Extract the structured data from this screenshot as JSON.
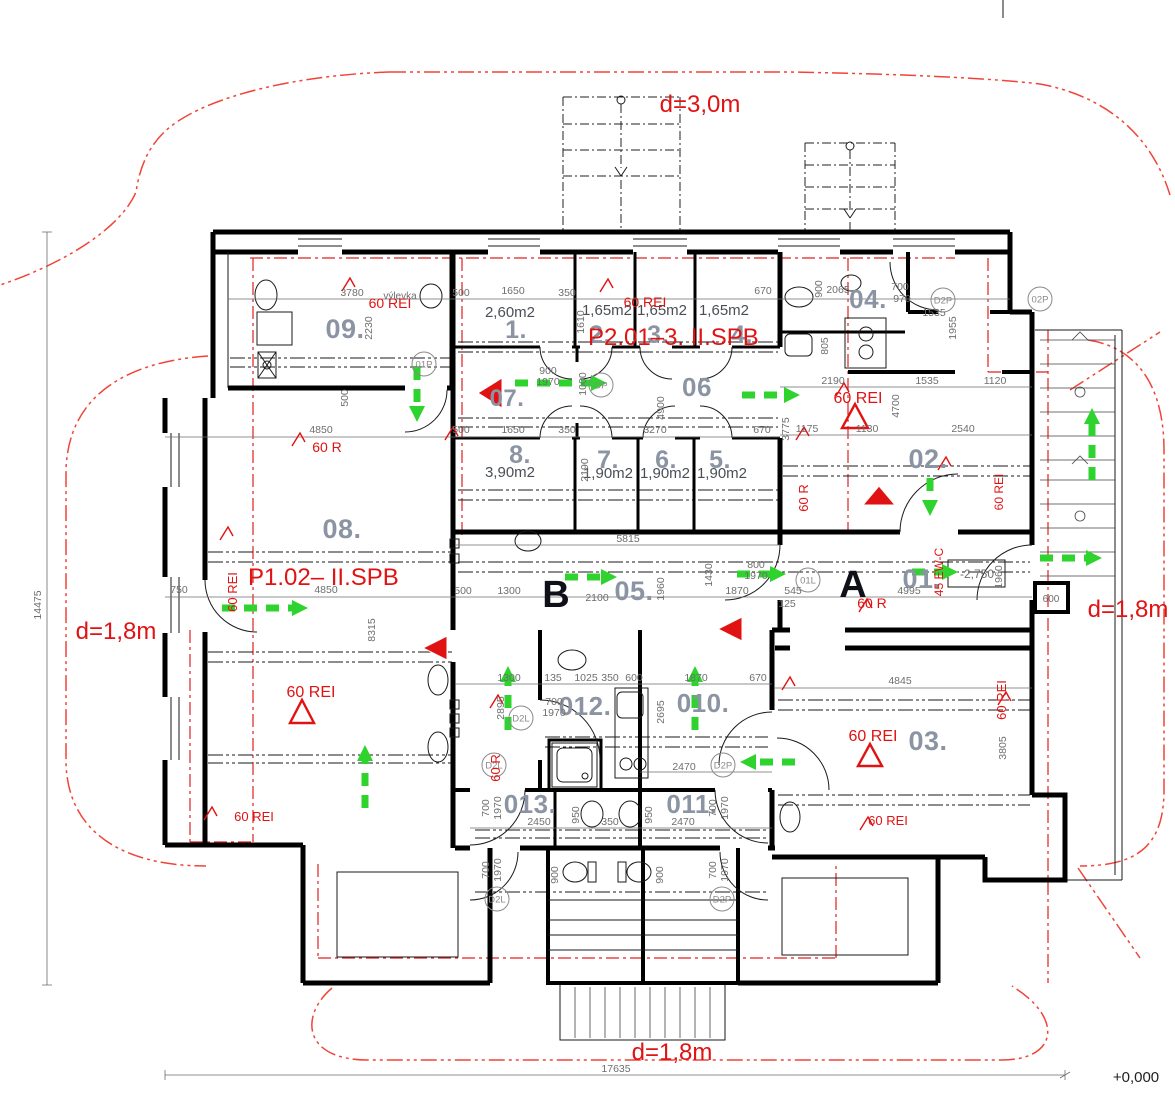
{
  "drawing": {
    "type": "architectural-floor-plan",
    "elevation_datum": "+0,000",
    "colors": {
      "walls": "#000000",
      "room_numbers": "#8b94a3",
      "fire_annotations": "#e11212",
      "escape_arrows": "#2ed32e",
      "dimensions": "#6e6e6e"
    }
  },
  "room_labels": [
    {
      "t": "09.",
      "x": 345,
      "y": 338,
      "s": 27
    },
    {
      "t": "1.",
      "x": 516,
      "y": 338,
      "s": 25
    },
    {
      "t": "2.",
      "x": 600,
      "y": 343,
      "s": 25
    },
    {
      "t": "3.",
      "x": 658,
      "y": 343,
      "s": 25
    },
    {
      "t": "4.",
      "x": 742,
      "y": 343,
      "s": 25
    },
    {
      "t": "07.",
      "x": 507,
      "y": 406,
      "s": 24
    },
    {
      "t": "06",
      "x": 697,
      "y": 396,
      "s": 26
    },
    {
      "t": "8.",
      "x": 520,
      "y": 463,
      "s": 25
    },
    {
      "t": "7.",
      "x": 608,
      "y": 468,
      "s": 25
    },
    {
      "t": "6.",
      "x": 666,
      "y": 468,
      "s": 25
    },
    {
      "t": "5.",
      "x": 720,
      "y": 468,
      "s": 25
    },
    {
      "t": "04.",
      "x": 868,
      "y": 308,
      "s": 26
    },
    {
      "t": "02.",
      "x": 928,
      "y": 468,
      "s": 27
    },
    {
      "t": "08.",
      "x": 342,
      "y": 538,
      "s": 27
    },
    {
      "t": "05.",
      "x": 634,
      "y": 600,
      "s": 27
    },
    {
      "t": "01.",
      "x": 922,
      "y": 588,
      "s": 27
    },
    {
      "t": "012.",
      "x": 585,
      "y": 715,
      "s": 26
    },
    {
      "t": "010.",
      "x": 703,
      "y": 712,
      "s": 26
    },
    {
      "t": "013.",
      "x": 530,
      "y": 813,
      "s": 26
    },
    {
      "t": "011.",
      "x": 692,
      "y": 813,
      "s": 26
    },
    {
      "t": "03.",
      "x": 928,
      "y": 750,
      "s": 27
    }
  ],
  "area_labels": [
    {
      "t": "2,60m2",
      "x": 510,
      "y": 317
    },
    {
      "t": "1,65m2",
      "x": 607,
      "y": 315
    },
    {
      "t": "1,65m2",
      "x": 662,
      "y": 315
    },
    {
      "t": "1,65m2",
      "x": 724,
      "y": 315
    },
    {
      "t": "3,90m2",
      "x": 510,
      "y": 477
    },
    {
      "t": "1,90m2",
      "x": 608,
      "y": 478
    },
    {
      "t": "1,90m2",
      "x": 665,
      "y": 478
    },
    {
      "t": "1,90m2",
      "x": 722,
      "y": 478
    }
  ],
  "section_letters": [
    {
      "t": "B",
      "x": 556,
      "y": 607
    },
    {
      "t": "A",
      "x": 853,
      "y": 597
    }
  ],
  "red_labels": [
    {
      "t": "d=3,0m",
      "x": 700,
      "y": 112,
      "s": 24
    },
    {
      "t": "d=1,8m",
      "x": 116,
      "y": 639,
      "s": 24
    },
    {
      "t": "d=1,8m",
      "x": 1128,
      "y": 617,
      "s": 24
    },
    {
      "t": "d=1,8m",
      "x": 672,
      "y": 1060,
      "s": 24
    },
    {
      "t": "P2.01–3. II.SPB",
      "x": 588,
      "y": 345,
      "s": 24,
      "a": "start"
    },
    {
      "t": "P1.02–  II.SPB",
      "x": 248,
      "y": 585,
      "s": 24,
      "a": "start"
    },
    {
      "t": "60 REI",
      "x": 390,
      "y": 308,
      "s": 14
    },
    {
      "t": "60 REI",
      "x": 645,
      "y": 307,
      "s": 14
    },
    {
      "t": "60 REI",
      "x": 858,
      "y": 403,
      "s": 16
    },
    {
      "t": "60 REI",
      "x": 311,
      "y": 697,
      "s": 16
    },
    {
      "t": "60 REI",
      "x": 254,
      "y": 821,
      "s": 13
    },
    {
      "t": "60 REI",
      "x": 873,
      "y": 741,
      "s": 16
    },
    {
      "t": "60 REI",
      "x": 888,
      "y": 825,
      "s": 13
    },
    {
      "t": "60 REI",
      "x": 237,
      "y": 592,
      "s": 13,
      "r": 1
    },
    {
      "t": "60 REI",
      "x": 1006,
      "y": 700,
      "s": 13,
      "r": 1
    },
    {
      "t": "60 REI",
      "x": 1003,
      "y": 492,
      "s": 12,
      "r": 1
    },
    {
      "t": "60 R",
      "x": 327,
      "y": 452,
      "s": 14
    },
    {
      "t": "60 R",
      "x": 872,
      "y": 608,
      "s": 14
    },
    {
      "t": "60 R",
      "x": 808,
      "y": 498,
      "s": 13,
      "r": 1
    },
    {
      "t": "60 R",
      "x": 500,
      "y": 768,
      "s": 13,
      "r": 1
    },
    {
      "t": "45 EW-C",
      "x": 943,
      "y": 572,
      "s": 12,
      "r": 1
    }
  ],
  "dim_labels": [
    [
      "3780",
      352,
      296
    ],
    [
      "500",
      461,
      296
    ],
    [
      "1650",
      513,
      294
    ],
    [
      "350",
      567,
      296
    ],
    [
      "670",
      763,
      294
    ],
    [
      "2065",
      838,
      293
    ],
    [
      "900",
      822,
      289,
      1
    ],
    [
      "700",
      900,
      290
    ],
    [
      "970",
      902,
      302
    ],
    [
      "1535",
      934,
      316
    ],
    [
      "1955",
      956,
      328,
      1
    ],
    [
      "805",
      828,
      346,
      1
    ],
    [
      "500",
      461,
      433
    ],
    [
      "1650",
      513,
      433
    ],
    [
      "350",
      567,
      433
    ],
    [
      "3270",
      655,
      433
    ],
    [
      "670",
      762,
      433
    ],
    [
      "3775",
      789,
      429,
      1
    ],
    [
      "2190",
      833,
      384
    ],
    [
      "4700",
      899,
      406,
      1
    ],
    [
      "1535",
      927,
      384
    ],
    [
      "1120",
      995,
      384
    ],
    [
      "1175",
      807,
      432
    ],
    [
      "1130",
      867,
      432
    ],
    [
      "2540",
      963,
      432
    ],
    [
      "2230",
      372,
      328,
      1
    ],
    [
      "500",
      348,
      398,
      1
    ],
    [
      "4850",
      321,
      433
    ],
    [
      "1610",
      584,
      322,
      1
    ],
    [
      "750",
      179,
      593
    ],
    [
      "14475",
      41,
      605,
      1
    ],
    [
      "4850",
      326,
      593
    ],
    [
      "8315",
      375,
      630,
      1
    ],
    [
      "500",
      463,
      594
    ],
    [
      "1300",
      509,
      594
    ],
    [
      "2100",
      597,
      601
    ],
    [
      "5815",
      628,
      542
    ],
    [
      "1960",
      664,
      589,
      1
    ],
    [
      "1870",
      737,
      594
    ],
    [
      "545",
      793,
      594
    ],
    [
      "125",
      787,
      607
    ],
    [
      "800",
      756,
      568
    ],
    [
      "1970",
      756,
      579
    ],
    [
      "1430",
      712,
      575,
      1
    ],
    [
      "4995",
      909,
      594
    ],
    [
      "1960",
      1002,
      577,
      1
    ],
    [
      "900",
      548,
      374
    ],
    [
      "1970",
      548,
      385
    ],
    [
      "1000",
      586,
      384,
      1
    ],
    [
      "4900",
      664,
      408,
      1
    ],
    [
      "2190",
      588,
      470,
      1
    ],
    [
      "4845",
      900,
      684
    ],
    [
      "3805",
      1006,
      748,
      1
    ],
    [
      "1300",
      509,
      681
    ],
    [
      "135",
      553,
      681
    ],
    [
      "1025",
      586,
      681
    ],
    [
      "350",
      610,
      681
    ],
    [
      "600",
      634,
      681
    ],
    [
      "1870",
      696,
      681
    ],
    [
      "670",
      758,
      681
    ],
    [
      "2895",
      504,
      708,
      1
    ],
    [
      "700",
      554,
      705
    ],
    [
      "1970",
      554,
      716
    ],
    [
      "2695",
      664,
      712,
      1
    ],
    [
      "2470",
      684,
      770
    ],
    [
      "2450",
      539,
      825
    ],
    [
      "350",
      610,
      825
    ],
    [
      "2470",
      683,
      825
    ],
    [
      "950",
      579,
      815,
      1
    ],
    [
      "950",
      652,
      815,
      1
    ],
    [
      "700",
      489,
      808,
      1
    ],
    [
      "1970",
      501,
      808,
      1
    ],
    [
      "700",
      716,
      808,
      1
    ],
    [
      "1970",
      728,
      808,
      1
    ],
    [
      "700",
      489,
      870,
      1
    ],
    [
      "1970",
      501,
      870,
      1
    ],
    [
      "700",
      716,
      870,
      1
    ],
    [
      "1970",
      728,
      870,
      1
    ],
    [
      "900",
      558,
      875,
      1
    ],
    [
      "900",
      663,
      875,
      1
    ],
    [
      "17635",
      616,
      1072
    ]
  ],
  "misc_labels": [
    {
      "t": "+0,000",
      "x": 1136,
      "y": 1082,
      "s": 15,
      "cls": "blk"
    },
    {
      "t": "výlevka",
      "x": 400,
      "y": 299,
      "s": 10,
      "cls": "dim"
    },
    {
      "t": "-2,750",
      "x": 977,
      "y": 578,
      "s": 12,
      "cls": "dim"
    },
    {
      "t": "600",
      "x": 1051,
      "y": 602,
      "s": 10,
      "cls": "dim"
    }
  ],
  "door_tags": [
    {
      "t": "DP",
      "x": 601,
      "y": 385
    },
    {
      "t": "D2P",
      "x": 943,
      "y": 300
    },
    {
      "t": "02P",
      "x": 1040,
      "y": 299
    },
    {
      "t": "01L",
      "x": 808,
      "y": 580
    },
    {
      "t": "01P",
      "x": 424,
      "y": 364
    },
    {
      "t": "D2L",
      "x": 521,
      "y": 718
    },
    {
      "t": "D2L",
      "x": 494,
      "y": 765
    },
    {
      "t": "D2P",
      "x": 723,
      "y": 765
    },
    {
      "t": "D2L",
      "x": 497,
      "y": 899
    },
    {
      "t": "D2P",
      "x": 722,
      "y": 899
    }
  ],
  "escape_arrows": [
    [
      515,
      383,
      607,
      383
    ],
    [
      742,
      395,
      800,
      395
    ],
    [
      930,
      478,
      930,
      516
    ],
    [
      1092,
      480,
      1092,
      408
    ],
    [
      1040,
      558,
      1102,
      558
    ],
    [
      565,
      577,
      617,
      577
    ],
    [
      737,
      574,
      786,
      574
    ],
    [
      912,
      572,
      958,
      572
    ],
    [
      417,
      367,
      417,
      422
    ],
    [
      508,
      730,
      508,
      666
    ],
    [
      695,
      730,
      695,
      666
    ],
    [
      795,
      762,
      740,
      762
    ],
    [
      365,
      808,
      365,
      745
    ],
    [
      222,
      608,
      308,
      608
    ]
  ],
  "red_triangles_filled": [
    [
      502,
      378,
      502,
      408,
      478,
      393
    ],
    [
      742,
      617,
      742,
      641,
      718,
      629
    ],
    [
      863,
      505,
      895,
      505,
      879,
      486
    ],
    [
      447,
      636,
      447,
      660,
      423,
      648
    ]
  ],
  "red_triangles_hollow": [
    [
      842,
      428,
      868,
      428,
      855,
      404
    ],
    [
      290,
      723,
      314,
      723,
      302,
      700
    ],
    [
      858,
      766,
      882,
      766,
      870,
      744
    ]
  ],
  "leader_hooks": [
    [
      352,
      291
    ],
    [
      610,
      292
    ],
    [
      302,
      446
    ],
    [
      230,
      540
    ],
    [
      214,
      820
    ],
    [
      846,
      396
    ],
    [
      869,
      612
    ],
    [
      792,
      690
    ],
    [
      1008,
      705
    ],
    [
      870,
      830
    ],
    [
      948,
      470
    ],
    [
      500,
      708
    ],
    [
      806,
      440
    ],
    [
      455,
      440
    ]
  ]
}
